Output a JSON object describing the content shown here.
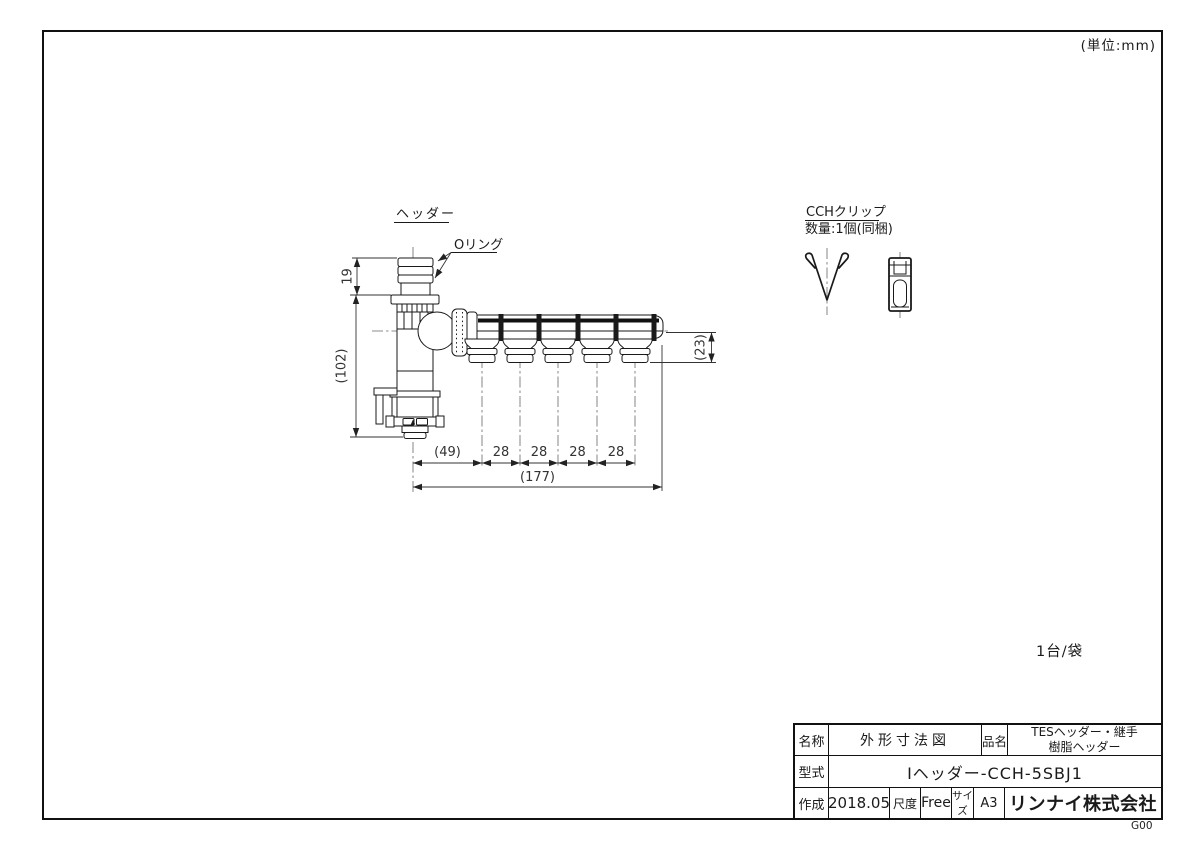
{
  "sheet": {
    "units_note": "(単位:mm)",
    "packaging_note": "1台/袋",
    "doc_code": "G00"
  },
  "drawing": {
    "part_label": "ヘッダー",
    "oring_label": "Oリング",
    "clip_title": "CCHクリップ",
    "clip_quantity": "数量:1個(同梱)",
    "dims": {
      "inlet_height": "19",
      "overall_height": "(102)",
      "outlet_drop": "(23)",
      "first_pitch": "(49)",
      "pitches": [
        "28",
        "28",
        "28",
        "28"
      ],
      "overall_length": "(177)"
    }
  },
  "title_block": {
    "name_label": "名称",
    "name_value": "外形寸法図",
    "item_label": "品名",
    "item_line1": "TESヘッダー・継手",
    "item_line2": "樹脂ヘッダー",
    "model_label": "型式",
    "model_value": "Iヘッダー-CCH-5SBJ1",
    "created_label": "作成",
    "created_value": "2018.05",
    "scale_label": "尺度",
    "scale_value": "Free",
    "size_label": "サイズ",
    "size_value": "A3",
    "company": "リンナイ株式会社"
  }
}
